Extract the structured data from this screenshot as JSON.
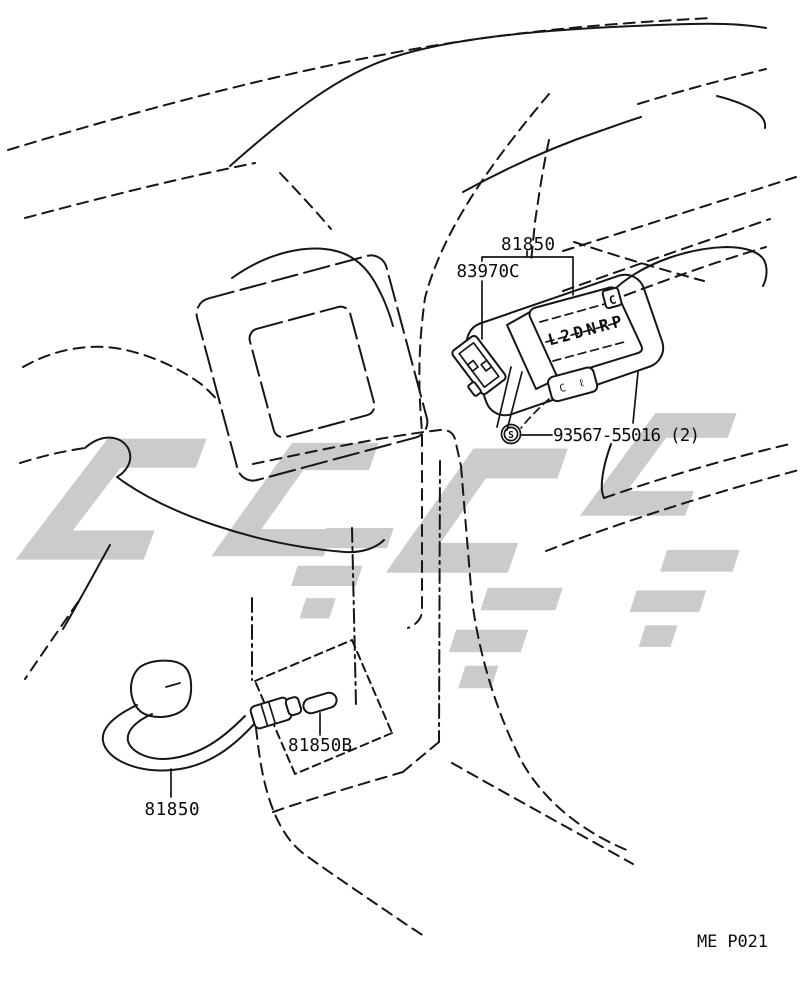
{
  "diagram": {
    "footer_code": "ME P021",
    "colors": {
      "line": "#161616",
      "watermark": "#cbcbcb",
      "background": "#ffffff"
    },
    "callouts": {
      "indicator_assy_top": {
        "label": "81850"
      },
      "connector": {
        "label": "83970C"
      },
      "screw": {
        "label": "93567-55016 (2)",
        "symbol": "S"
      },
      "clip": {
        "label": "81850B"
      },
      "wire_bottom": {
        "label": "81850"
      }
    },
    "unit_markings": {
      "display_text": "L2DNRP",
      "key_text": "C",
      "plate_text": "C ℓ"
    }
  }
}
